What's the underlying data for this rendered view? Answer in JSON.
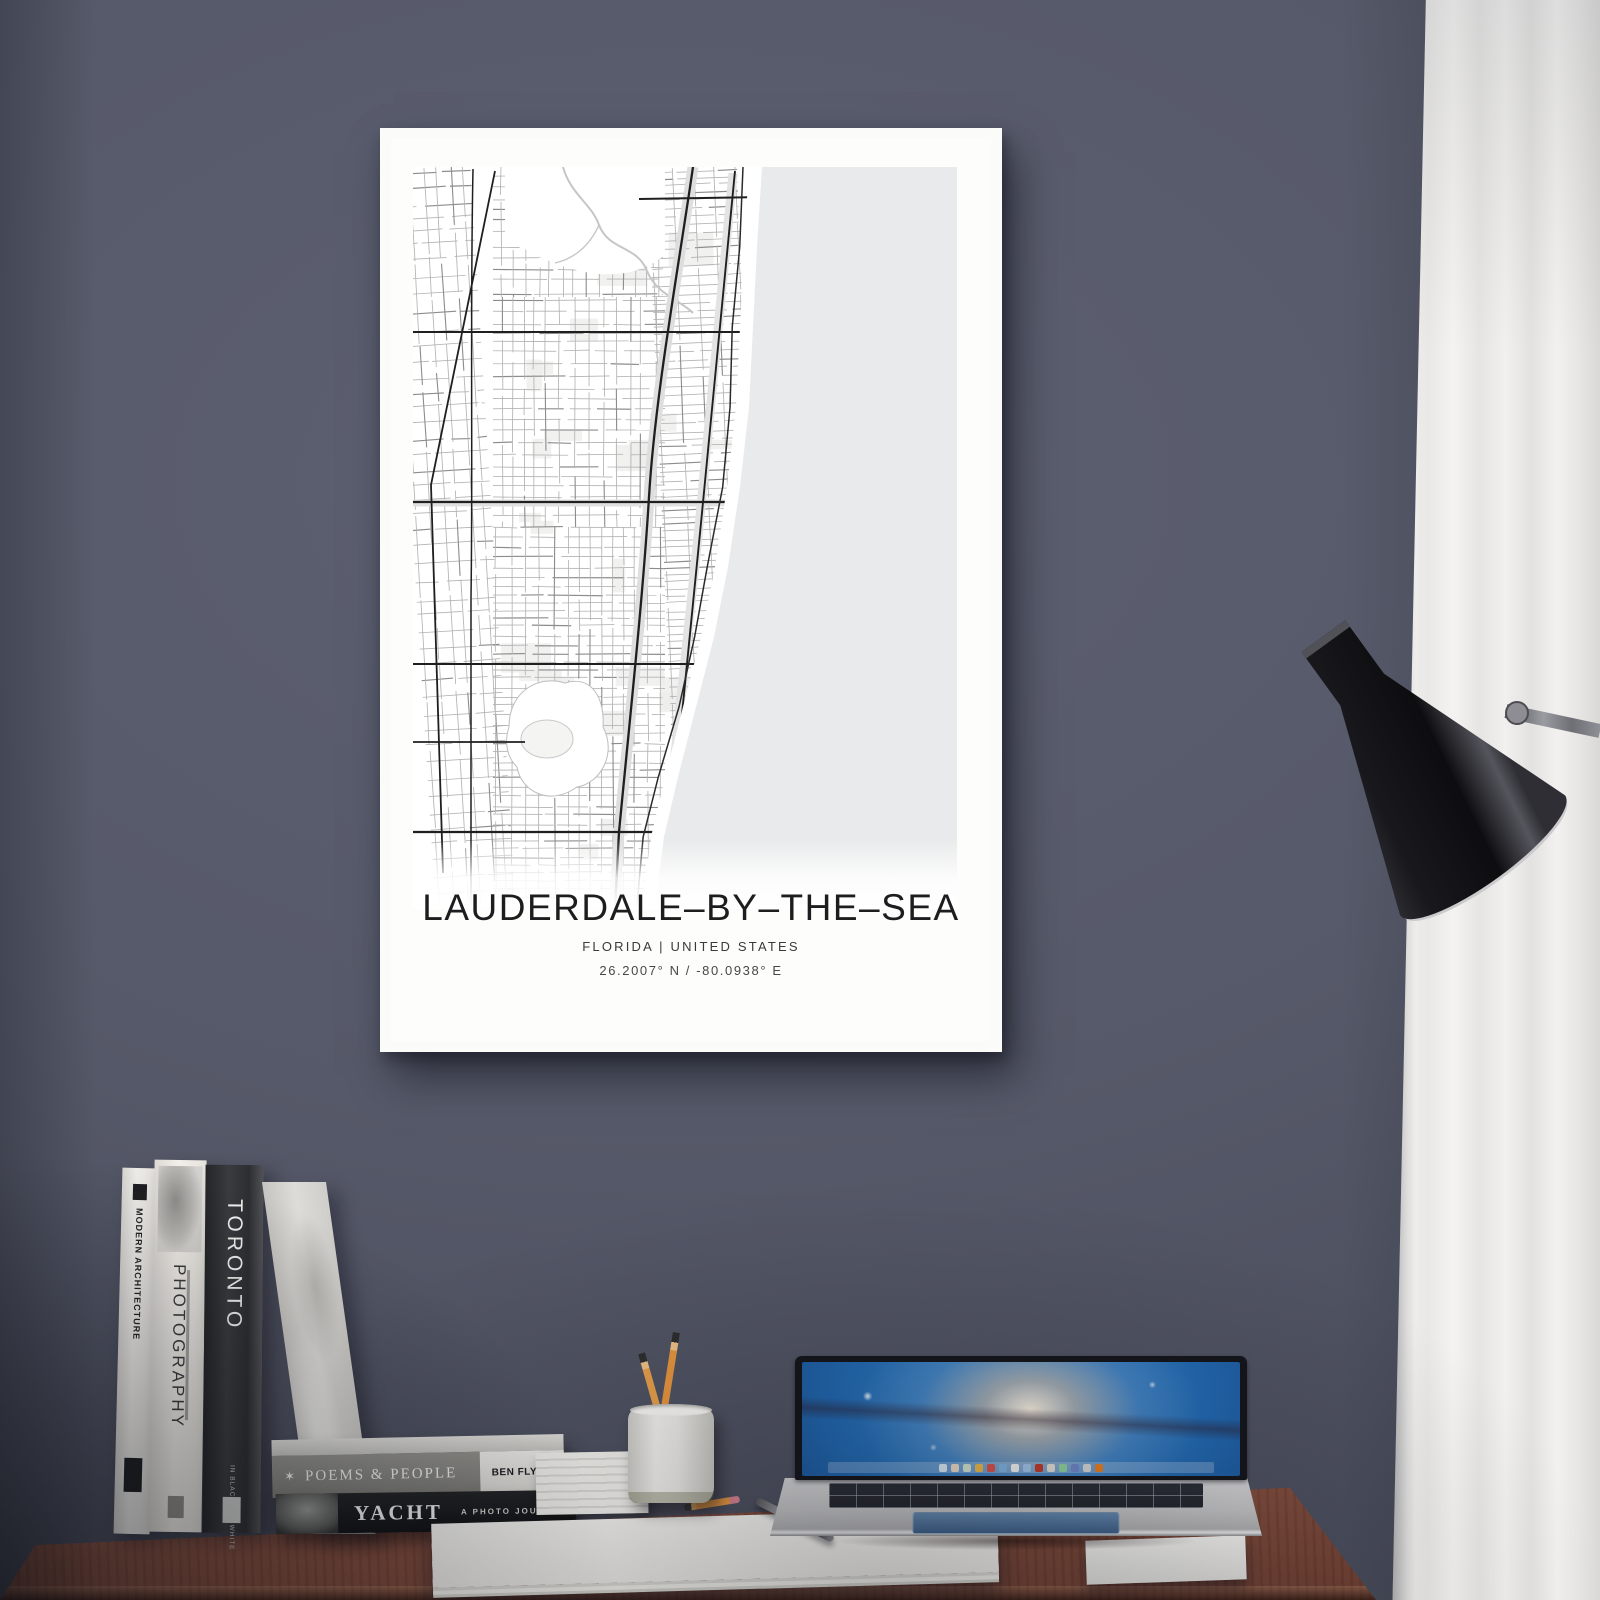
{
  "poster": {
    "title": "LAUDERDALE–BY–THE–SEA",
    "region_line": "FLORIDA | UNITED STATES",
    "coordinates_line": "26.2007° N / -80.0938° E",
    "map_colors": {
      "land": "#ffffff",
      "ocean": "#e9eaeb",
      "minor_road": "#b3b3b3",
      "mid_road": "#8c8c8c",
      "major_road": "#1f1f1f",
      "pale_road": "#dedede",
      "water_line": "#c6c6c6"
    }
  },
  "books": {
    "standing": [
      {
        "spine_title": "MODERN ARCHITECTURE"
      },
      {
        "spine_title": "PHOTOGRAPHY"
      },
      {
        "spine_title": "TORONTO",
        "spine_subtitle": "IN BLACK AND WHITE"
      }
    ],
    "stacked": [
      {
        "spine_title": "POEMS & PEOPLE",
        "star_glyph": "✶",
        "edge_text": "BEN FLYNN"
      },
      {
        "spine_title": "YACHT",
        "spine_subtitle": "A PHOTO JOURNAL"
      }
    ]
  },
  "scene_colors": {
    "wall": "#565969",
    "desk_wood": "#7c4839",
    "curtain": "#efeeec",
    "frame": "#fbfbfa",
    "lamp_shade": "#141416"
  }
}
